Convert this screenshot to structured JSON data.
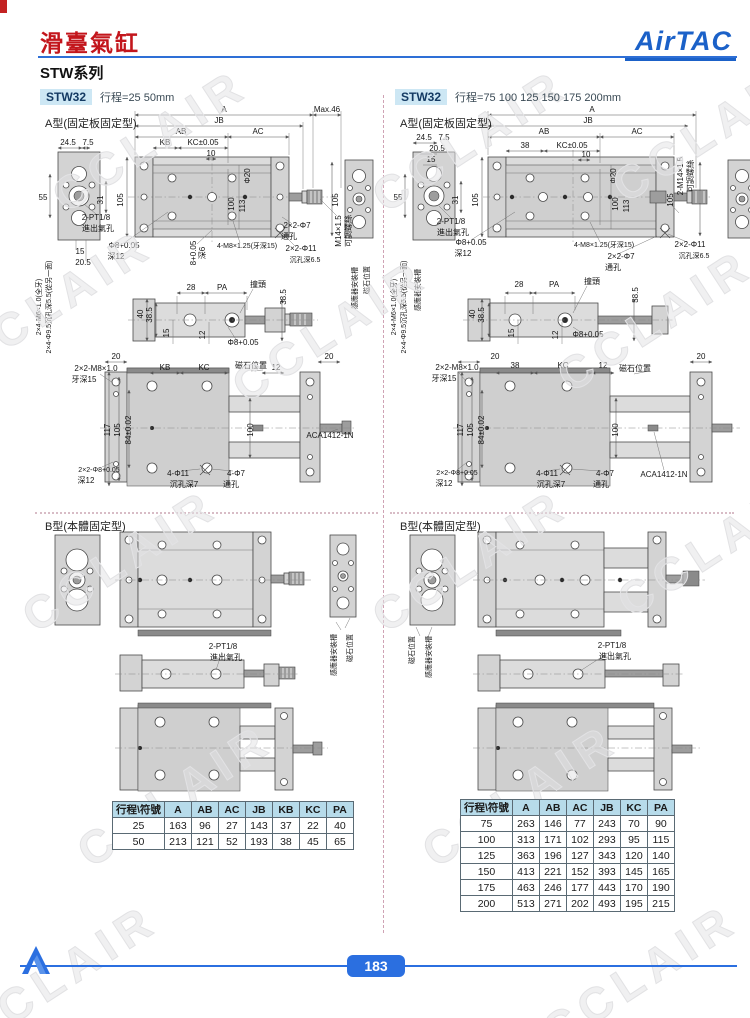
{
  "header": {
    "title": "滑臺氣缸",
    "series": "STW系列",
    "logo": "AirTAC"
  },
  "footer": {
    "page": "183"
  },
  "colors": {
    "accent_blue": "#2b6fe0",
    "title_red": "#c3161c",
    "badge_bg": "#cde7f4",
    "table_header_bg": "#b7dbea"
  },
  "left": {
    "model": "STW32",
    "stroke": "行程=25 50mm",
    "type_a": "A型(固定板固定型)",
    "type_b": "B型(本體固定型)",
    "table": {
      "headers": [
        "行程\\符號",
        "A",
        "AB",
        "AC",
        "JB",
        "KB",
        "KC",
        "PA"
      ],
      "rows": [
        [
          "25",
          "163",
          "96",
          "27",
          "143",
          "37",
          "22",
          "40"
        ],
        [
          "50",
          "213",
          "121",
          "52",
          "193",
          "38",
          "45",
          "65"
        ]
      ]
    }
  },
  "right": {
    "model": "STW32",
    "stroke": "行程=75 100 125 150 175 200mm",
    "type_a": "A型(固定板固定型)",
    "type_b": "B型(本體固定型)",
    "table": {
      "headers": [
        "行程\\符號",
        "A",
        "AB",
        "AC",
        "JB",
        "KC",
        "PA"
      ],
      "rows": [
        [
          "75",
          "263",
          "146",
          "77",
          "243",
          "70",
          "90"
        ],
        [
          "100",
          "313",
          "171",
          "102",
          "293",
          "95",
          "115"
        ],
        [
          "125",
          "363",
          "196",
          "127",
          "343",
          "120",
          "140"
        ],
        [
          "150",
          "413",
          "221",
          "152",
          "393",
          "145",
          "165"
        ],
        [
          "175",
          "463",
          "246",
          "177",
          "443",
          "170",
          "190"
        ],
        [
          "200",
          "513",
          "271",
          "202",
          "493",
          "195",
          "215"
        ]
      ]
    }
  },
  "watermark": {
    "text": "CCLAIR",
    "positions": [
      {
        "x": 150,
        "y": 140
      },
      {
        "x": 470,
        "y": 140
      },
      {
        "x": 710,
        "y": 130
      },
      {
        "x": 55,
        "y": 300
      },
      {
        "x": 330,
        "y": 330
      },
      {
        "x": 655,
        "y": 320
      },
      {
        "x": 120,
        "y": 560
      },
      {
        "x": 470,
        "y": 560
      },
      {
        "x": 715,
        "y": 545
      },
      {
        "x": 175,
        "y": 795
      },
      {
        "x": 520,
        "y": 795
      },
      {
        "x": 60,
        "y": 975
      },
      {
        "x": 640,
        "y": 975
      }
    ]
  },
  "labels": [
    {
      "t": "A",
      "x": 224,
      "y": 112
    },
    {
      "t": "JB",
      "x": 219,
      "y": 123
    },
    {
      "t": "AB",
      "x": 181,
      "y": 134
    },
    {
      "t": "AC",
      "x": 258,
      "y": 134
    },
    {
      "t": "KB",
      "x": 165,
      "y": 145
    },
    {
      "t": "KC±0.05",
      "x": 203,
      "y": 145
    },
    {
      "t": "10",
      "x": 211,
      "y": 156
    },
    {
      "t": "Max.46",
      "x": 327,
      "y": 112
    },
    {
      "t": "24.5",
      "x": 68,
      "y": 145
    },
    {
      "t": "7.5",
      "x": 88,
      "y": 145
    },
    {
      "t": "55",
      "x": 43,
      "y": 200
    },
    {
      "t": "31",
      "x": 103,
      "y": 200,
      "r": -90
    },
    {
      "t": "105",
      "x": 123,
      "y": 200,
      "r": -90
    },
    {
      "t": "Φ20",
      "x": 250,
      "y": 176,
      "r": -90
    },
    {
      "t": "100",
      "x": 234,
      "y": 204,
      "r": -90
    },
    {
      "t": "113",
      "x": 245,
      "y": 206,
      "r": -90
    },
    {
      "t": "105",
      "x": 338,
      "y": 200,
      "r": -90
    },
    {
      "t": "2-PT1/8",
      "x": 96,
      "y": 220
    },
    {
      "t": "進出氣孔",
      "x": 98,
      "y": 231
    },
    {
      "t": "15",
      "x": 80,
      "y": 254
    },
    {
      "t": "20.5",
      "x": 83,
      "y": 265
    },
    {
      "t": "Φ8+0.05",
      "x": 124,
      "y": 248
    },
    {
      "t": "深12",
      "x": 116,
      "y": 259
    },
    {
      "t": "8+0.05",
      "x": 196,
      "y": 253,
      "r": -90
    },
    {
      "t": "深6",
      "x": 205,
      "y": 253,
      "r": -90
    },
    {
      "t": "4-M8×1.25(牙深15)",
      "x": 247,
      "y": 248,
      "s": 7
    },
    {
      "t": "2×2-Φ7",
      "x": 297,
      "y": 228
    },
    {
      "t": "通孔",
      "x": 289,
      "y": 239
    },
    {
      "t": "2×2-Φ11",
      "x": 301,
      "y": 251
    },
    {
      "t": "沉孔深6.5",
      "x": 305,
      "y": 262,
      "s": 7
    },
    {
      "t": "M14×1.5",
      "x": 341,
      "y": 231,
      "r": -90
    },
    {
      "t": "可調螺絲",
      "x": 351,
      "y": 231,
      "r": -90
    },
    {
      "t": "2×4-M6×1.0(全牙)",
      "x": 41,
      "y": 307,
      "r": -90,
      "s": 7
    },
    {
      "t": "2×4-Φ9.5沉孔深5.5(從另一面)",
      "x": 51,
      "y": 307,
      "r": -90,
      "s": 7
    },
    {
      "t": "感應器安裝槽",
      "x": 357,
      "y": 288,
      "r": -90,
      "s": 7
    },
    {
      "t": "磁石位置",
      "x": 369,
      "y": 280,
      "r": -90,
      "s": 7
    },
    {
      "t": "28",
      "x": 191,
      "y": 290
    },
    {
      "t": "PA",
      "x": 222,
      "y": 290
    },
    {
      "t": "撞頭",
      "x": 258,
      "y": 287
    },
    {
      "t": "38.5",
      "x": 286,
      "y": 297,
      "r": -90
    },
    {
      "t": "40",
      "x": 143,
      "y": 314,
      "r": -90
    },
    {
      "t": "38.5",
      "x": 152,
      "y": 315,
      "r": -90
    },
    {
      "t": "15",
      "x": 169,
      "y": 333,
      "r": -90
    },
    {
      "t": "12",
      "x": 205,
      "y": 335,
      "r": -90
    },
    {
      "t": "Φ8+0.05",
      "x": 243,
      "y": 345
    },
    {
      "t": "20",
      "x": 116,
      "y": 359
    },
    {
      "t": "2×2-M8×1.0",
      "x": 96,
      "y": 371
    },
    {
      "t": "牙深15",
      "x": 84,
      "y": 382
    },
    {
      "t": "KB",
      "x": 165,
      "y": 370
    },
    {
      "t": "KC",
      "x": 204,
      "y": 370
    },
    {
      "t": "磁石位置",
      "x": 251,
      "y": 368
    },
    {
      "t": "12",
      "x": 276,
      "y": 370
    },
    {
      "t": "20",
      "x": 329,
      "y": 359
    },
    {
      "t": "117",
      "x": 110,
      "y": 430,
      "r": -90
    },
    {
      "t": "105",
      "x": 120,
      "y": 430,
      "r": -90
    },
    {
      "t": "84±0.02",
      "x": 131,
      "y": 430,
      "r": -90
    },
    {
      "t": "100",
      "x": 253,
      "y": 430,
      "r": -90
    },
    {
      "t": "ACA1412-1N",
      "x": 330,
      "y": 438
    },
    {
      "t": "2×2-Φ8+0.05",
      "x": 99,
      "y": 472,
      "s": 7
    },
    {
      "t": "深12",
      "x": 86,
      "y": 483
    },
    {
      "t": "4-Φ11",
      "x": 178,
      "y": 476
    },
    {
      "t": "沉孔深7",
      "x": 184,
      "y": 487
    },
    {
      "t": "4-Φ7",
      "x": 236,
      "y": 476
    },
    {
      "t": "通孔",
      "x": 231,
      "y": 487
    },
    {
      "t": "2-PT1/8",
      "x": 223,
      "y": 649
    },
    {
      "t": "進出氣孔",
      "x": 226,
      "y": 660
    },
    {
      "t": "感應器安裝槽",
      "x": 336,
      "y": 655,
      "r": -90,
      "s": 7
    },
    {
      "t": "磁石位置",
      "x": 352,
      "y": 648,
      "r": -90,
      "s": 7
    },
    {
      "t": "24.5",
      "x": 424,
      "y": 140
    },
    {
      "t": "7.5",
      "x": 444,
      "y": 140
    },
    {
      "t": "20.5",
      "x": 437,
      "y": 151
    },
    {
      "t": "15",
      "x": 431,
      "y": 162
    },
    {
      "t": "A",
      "x": 592,
      "y": 112
    },
    {
      "t": "JB",
      "x": 588,
      "y": 123
    },
    {
      "t": "AB",
      "x": 544,
      "y": 134
    },
    {
      "t": "AC",
      "x": 637,
      "y": 134
    },
    {
      "t": "38",
      "x": 525,
      "y": 148
    },
    {
      "t": "KC±0.05",
      "x": 572,
      "y": 148
    },
    {
      "t": "10",
      "x": 586,
      "y": 157
    },
    {
      "t": "55",
      "x": 398,
      "y": 200
    },
    {
      "t": "31",
      "x": 458,
      "y": 200,
      "r": -90
    },
    {
      "t": "105",
      "x": 478,
      "y": 200,
      "r": -90
    },
    {
      "t": "Φ20",
      "x": 616,
      "y": 176,
      "r": -90
    },
    {
      "t": "100",
      "x": 618,
      "y": 204,
      "r": -90
    },
    {
      "t": "113",
      "x": 629,
      "y": 206,
      "r": -90
    },
    {
      "t": "105",
      "x": 673,
      "y": 200,
      "r": -90
    },
    {
      "t": "2-M14×1.5",
      "x": 683,
      "y": 176,
      "r": -90
    },
    {
      "t": "可調螺絲",
      "x": 693,
      "y": 176,
      "r": -90
    },
    {
      "t": "2-PT1/8",
      "x": 451,
      "y": 224
    },
    {
      "t": "進出氣孔",
      "x": 453,
      "y": 235
    },
    {
      "t": "Φ8+0.05",
      "x": 471,
      "y": 245
    },
    {
      "t": "深12",
      "x": 463,
      "y": 256
    },
    {
      "t": "4-M8×1.25(牙深15)",
      "x": 604,
      "y": 247,
      "s": 7
    },
    {
      "t": "2×2-Φ7",
      "x": 621,
      "y": 259
    },
    {
      "t": "通孔",
      "x": 613,
      "y": 270
    },
    {
      "t": "2×2-Φ11",
      "x": 690,
      "y": 247
    },
    {
      "t": "沉孔深6.5",
      "x": 694,
      "y": 258,
      "s": 7
    },
    {
      "t": "2×4-M6×1.0(全牙)",
      "x": 396,
      "y": 307,
      "r": -90,
      "s": 7
    },
    {
      "t": "2×4-Φ9.5沉孔深5.5(從另一面)",
      "x": 406,
      "y": 307,
      "r": -90,
      "s": 7
    },
    {
      "t": "感應器安裝槽",
      "x": 420,
      "y": 290,
      "r": -90,
      "s": 7
    },
    {
      "t": "28",
      "x": 519,
      "y": 287
    },
    {
      "t": "PA",
      "x": 554,
      "y": 287
    },
    {
      "t": "撞頭",
      "x": 592,
      "y": 284
    },
    {
      "t": "38.5",
      "x": 638,
      "y": 295,
      "r": -90
    },
    {
      "t": "40",
      "x": 475,
      "y": 314,
      "r": -90
    },
    {
      "t": "38.5",
      "x": 484,
      "y": 315,
      "r": -90
    },
    {
      "t": "15",
      "x": 514,
      "y": 333,
      "r": -90
    },
    {
      "t": "12",
      "x": 558,
      "y": 335,
      "r": -90
    },
    {
      "t": "Φ8+0.05",
      "x": 588,
      "y": 337
    },
    {
      "t": "20",
      "x": 495,
      "y": 359
    },
    {
      "t": "38",
      "x": 515,
      "y": 368
    },
    {
      "t": "KC",
      "x": 563,
      "y": 368
    },
    {
      "t": "12",
      "x": 603,
      "y": 368
    },
    {
      "t": "磁石位置",
      "x": 635,
      "y": 371
    },
    {
      "t": "20",
      "x": 701,
      "y": 359
    },
    {
      "t": "2×2-M8×1.0",
      "x": 457,
      "y": 370
    },
    {
      "t": "牙深15",
      "x": 444,
      "y": 381
    },
    {
      "t": "117",
      "x": 463,
      "y": 430,
      "r": -90
    },
    {
      "t": "105",
      "x": 473,
      "y": 430,
      "r": -90
    },
    {
      "t": "84±0.02",
      "x": 484,
      "y": 430,
      "r": -90
    },
    {
      "t": "100",
      "x": 618,
      "y": 430,
      "r": -90
    },
    {
      "t": "2×2-Φ8+0.05",
      "x": 457,
      "y": 475,
      "s": 7
    },
    {
      "t": "深12",
      "x": 444,
      "y": 486
    },
    {
      "t": "4-Φ11",
      "x": 547,
      "y": 476
    },
    {
      "t": "沉孔深7",
      "x": 551,
      "y": 487
    },
    {
      "t": "4-Φ7",
      "x": 605,
      "y": 476
    },
    {
      "t": "通孔",
      "x": 601,
      "y": 487
    },
    {
      "t": "ACA1412-1N",
      "x": 664,
      "y": 477
    },
    {
      "t": "磁石位置",
      "x": 414,
      "y": 650,
      "r": -90,
      "s": 7
    },
    {
      "t": "感應器安裝槽",
      "x": 431,
      "y": 657,
      "r": -90,
      "s": 7
    },
    {
      "t": "2-PT1/8",
      "x": 612,
      "y": 648
    },
    {
      "t": "進出氣孔",
      "x": 615,
      "y": 659
    }
  ]
}
